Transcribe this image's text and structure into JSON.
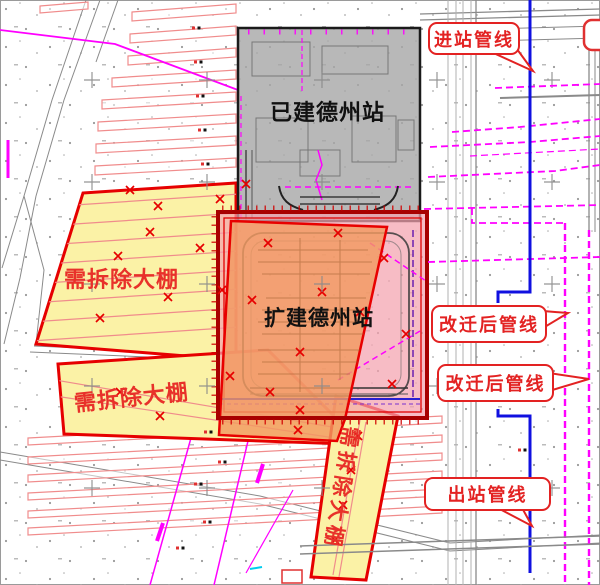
{
  "zones": {
    "existing_station": {
      "label": "已建德州站"
    },
    "expanded_station": {
      "label": "扩建德州站"
    },
    "demolish_upper": {
      "label": "需拆除大棚"
    },
    "demolish_mid": {
      "label": "需拆除大棚"
    },
    "demolish_diag": {
      "label": "需拆除大棚"
    }
  },
  "callouts": {
    "inlet": {
      "label": "进站管线"
    },
    "relocated_1": {
      "label": "改迁后管线"
    },
    "relocated_2": {
      "label": "改迁后管线"
    },
    "outlet": {
      "label": "出站管线"
    }
  },
  "colors": {
    "demolish_fill": "#FBF2A6",
    "demolish_border": "#E60000",
    "expansion_fill": "#F4A2AE",
    "expansion_border": "#A80000",
    "orange_fill": "#F19A60",
    "existing_fill": "#A6A6A6",
    "existing_border": "#1A1A1A",
    "pipeline_blue": "#1010E0",
    "pipeline_magenta": "#FF00FF",
    "callout_red": "#E32222",
    "label_red": "#E8312A",
    "label_black": "#111111",
    "greenhouse_stroke": "#F08C8C"
  }
}
